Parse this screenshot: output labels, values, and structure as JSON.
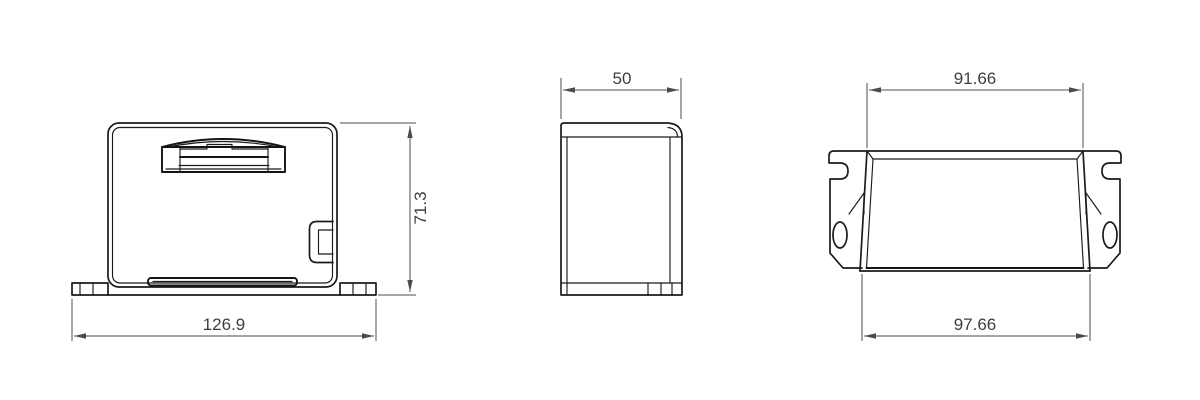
{
  "drawing": {
    "type": "technical-dimension-drawing",
    "views": {
      "front": "front-view",
      "side": "side-view",
      "rear": "rear-view"
    }
  },
  "dimensions": {
    "front_width": "126.9",
    "front_height": "71.3",
    "side_depth": "50",
    "rear_top_width": "91.66",
    "rear_bottom_width": "97.66"
  },
  "colors": {
    "background": "#ffffff",
    "object_line": "#1b1b1b",
    "dimension_line": "#4c4c4c",
    "dimension_text": "#3c4046"
  }
}
